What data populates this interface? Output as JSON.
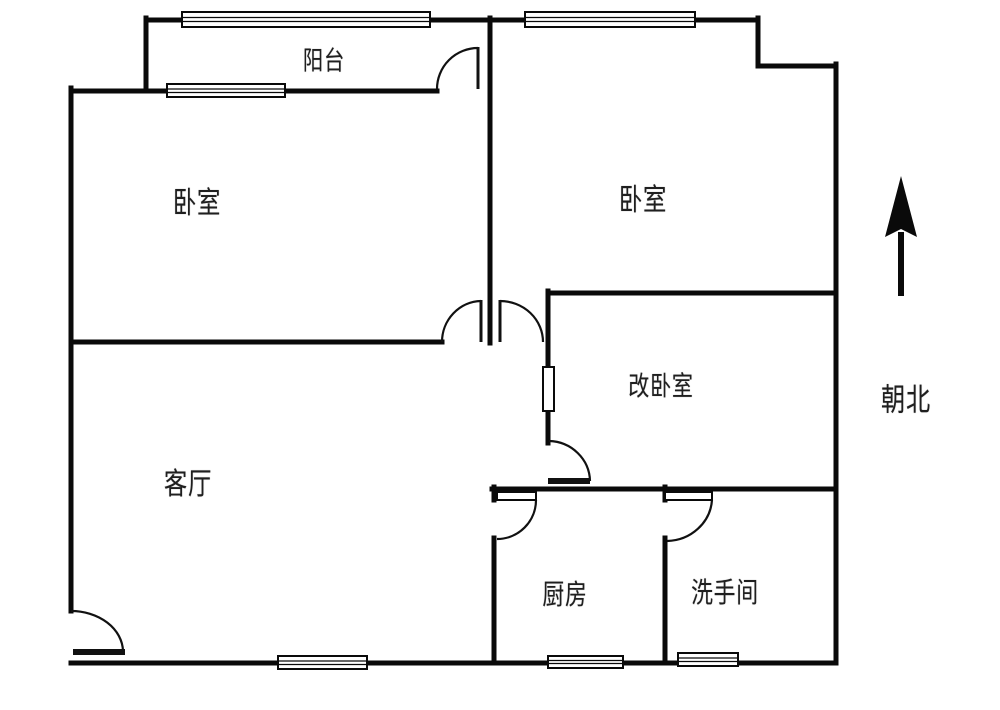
{
  "colors": {
    "background": "#ffffff",
    "wall": "#0a0a0a",
    "door_line": "#111111",
    "label_text": "#1f1f1f"
  },
  "rooms": [
    {
      "name": "balcony",
      "label": "阳台"
    },
    {
      "name": "bedroom-left",
      "label": "卧室"
    },
    {
      "name": "bedroom-right",
      "label": "卧室"
    },
    {
      "name": "converted-bedroom",
      "label": "改卧室"
    },
    {
      "name": "living-room",
      "label": "客厅"
    },
    {
      "name": "kitchen",
      "label": "厨房"
    },
    {
      "name": "bathroom",
      "label": "洗手间"
    }
  ],
  "compass": {
    "icon": "north-arrow-icon",
    "direction_label": "朝北"
  }
}
